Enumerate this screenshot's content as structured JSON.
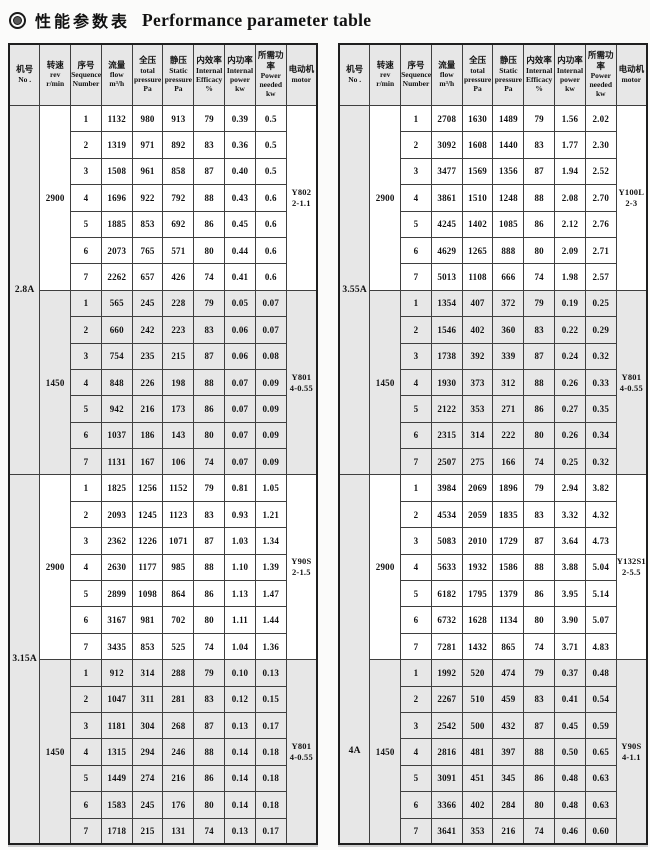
{
  "title": {
    "zh": "性能参数表",
    "en": "Performance parameter table"
  },
  "colors": {
    "cell_shade": "#e7e7e7",
    "cell_white": "#ffffff",
    "border": "#3f3f3f",
    "outer_border": "#1f1f1f",
    "text": "#111111"
  },
  "columns": [
    {
      "zh": "机号",
      "en": "No ."
    },
    {
      "zh": "转速",
      "en": "rev\nr/min"
    },
    {
      "zh": "序号",
      "en": "Sequence\nNumber"
    },
    {
      "zh": "流量",
      "en": "flow\nm³/h"
    },
    {
      "zh": "全压",
      "en": "total\npressure\nPa"
    },
    {
      "zh": "静压",
      "en": "Static\npressure\nPa"
    },
    {
      "zh": "内效率",
      "en": "Internal\nEfficacy\n%"
    },
    {
      "zh": "内功率",
      "en": "Internal\npower\nkw"
    },
    {
      "zh": "所需功率",
      "en": "Power\nneeded\nkw"
    },
    {
      "zh": "电动机",
      "en": "motor"
    }
  ],
  "tables": [
    {
      "name": "performance-table-left",
      "sections": [
        {
          "no": "2.8A",
          "label_pos": "50%",
          "blocks": [
            {
              "rpm": "2900",
              "shade": "white",
              "motor": "Y802\n2-1.1",
              "rows": [
                [
                  "1",
                  "1132",
                  "980",
                  "913",
                  "79",
                  "0.39",
                  "0.5"
                ],
                [
                  "2",
                  "1319",
                  "971",
                  "892",
                  "83",
                  "0.36",
                  "0.5"
                ],
                [
                  "3",
                  "1508",
                  "961",
                  "858",
                  "87",
                  "0.40",
                  "0.5"
                ],
                [
                  "4",
                  "1696",
                  "922",
                  "792",
                  "88",
                  "0.43",
                  "0.6"
                ],
                [
                  "5",
                  "1885",
                  "853",
                  "692",
                  "86",
                  "0.45",
                  "0.6"
                ],
                [
                  "6",
                  "2073",
                  "765",
                  "571",
                  "80",
                  "0.44",
                  "0.6"
                ],
                [
                  "7",
                  "2262",
                  "657",
                  "426",
                  "74",
                  "0.41",
                  "0.6"
                ]
              ]
            },
            {
              "rpm": "1450",
              "shade": "gray",
              "motor": "Y801\n4-0.55",
              "rows": [
                [
                  "1",
                  "565",
                  "245",
                  "228",
                  "79",
                  "0.05",
                  "0.07"
                ],
                [
                  "2",
                  "660",
                  "242",
                  "223",
                  "83",
                  "0.06",
                  "0.07"
                ],
                [
                  "3",
                  "754",
                  "235",
                  "215",
                  "87",
                  "0.06",
                  "0.08"
                ],
                [
                  "4",
                  "848",
                  "226",
                  "198",
                  "88",
                  "0.07",
                  "0.09"
                ],
                [
                  "5",
                  "942",
                  "216",
                  "173",
                  "86",
                  "0.07",
                  "0.09"
                ],
                [
                  "6",
                  "1037",
                  "186",
                  "143",
                  "80",
                  "0.07",
                  "0.09"
                ],
                [
                  "7",
                  "1131",
                  "167",
                  "106",
                  "74",
                  "0.07",
                  "0.09"
                ]
              ]
            }
          ]
        },
        {
          "no": "3.15A",
          "label_pos": "50%",
          "blocks": [
            {
              "rpm": "2900",
              "shade": "white",
              "motor": "Y90S\n2-1.5",
              "rows": [
                [
                  "1",
                  "1825",
                  "1256",
                  "1152",
                  "79",
                  "0.81",
                  "1.05"
                ],
                [
                  "2",
                  "2093",
                  "1245",
                  "1123",
                  "83",
                  "0.93",
                  "1.21"
                ],
                [
                  "3",
                  "2362",
                  "1226",
                  "1071",
                  "87",
                  "1.03",
                  "1.34"
                ],
                [
                  "4",
                  "2630",
                  "1177",
                  "985",
                  "88",
                  "1.10",
                  "1.39"
                ],
                [
                  "5",
                  "2899",
                  "1098",
                  "864",
                  "86",
                  "1.13",
                  "1.47"
                ],
                [
                  "6",
                  "3167",
                  "981",
                  "702",
                  "80",
                  "1.11",
                  "1.44"
                ],
                [
                  "7",
                  "3435",
                  "853",
                  "525",
                  "74",
                  "1.04",
                  "1.36"
                ]
              ]
            },
            {
              "rpm": "1450",
              "shade": "gray",
              "motor": "Y801\n4-0.55",
              "rows": [
                [
                  "1",
                  "912",
                  "314",
                  "288",
                  "79",
                  "0.10",
                  "0.13"
                ],
                [
                  "2",
                  "1047",
                  "311",
                  "281",
                  "83",
                  "0.12",
                  "0.15"
                ],
                [
                  "3",
                  "1181",
                  "304",
                  "268",
                  "87",
                  "0.13",
                  "0.17"
                ],
                [
                  "4",
                  "1315",
                  "294",
                  "246",
                  "88",
                  "0.14",
                  "0.18"
                ],
                [
                  "5",
                  "1449",
                  "274",
                  "216",
                  "86",
                  "0.14",
                  "0.18"
                ],
                [
                  "6",
                  "1583",
                  "245",
                  "176",
                  "80",
                  "0.14",
                  "0.18"
                ],
                [
                  "7",
                  "1718",
                  "215",
                  "131",
                  "74",
                  "0.13",
                  "0.17"
                ]
              ]
            }
          ]
        }
      ]
    },
    {
      "name": "performance-table-right",
      "sections": [
        {
          "no": "3.55A",
          "label_pos": "50%",
          "blocks": [
            {
              "rpm": "2900",
              "shade": "white",
              "motor": "Y100L\n2-3",
              "rows": [
                [
                  "1",
                  "2708",
                  "1630",
                  "1489",
                  "79",
                  "1.56",
                  "2.02"
                ],
                [
                  "2",
                  "3092",
                  "1608",
                  "1440",
                  "83",
                  "1.77",
                  "2.30"
                ],
                [
                  "3",
                  "3477",
                  "1569",
                  "1356",
                  "87",
                  "1.94",
                  "2.52"
                ],
                [
                  "4",
                  "3861",
                  "1510",
                  "1248",
                  "88",
                  "2.08",
                  "2.70"
                ],
                [
                  "5",
                  "4245",
                  "1402",
                  "1085",
                  "86",
                  "2.12",
                  "2.76"
                ],
                [
                  "6",
                  "4629",
                  "1265",
                  "888",
                  "80",
                  "2.09",
                  "2.71"
                ],
                [
                  "7",
                  "5013",
                  "1108",
                  "666",
                  "74",
                  "1.98",
                  "2.57"
                ]
              ]
            },
            {
              "rpm": "1450",
              "shade": "gray",
              "motor": "Y801\n4-0.55",
              "rows": [
                [
                  "1",
                  "1354",
                  "407",
                  "372",
                  "79",
                  "0.19",
                  "0.25"
                ],
                [
                  "2",
                  "1546",
                  "402",
                  "360",
                  "83",
                  "0.22",
                  "0.29"
                ],
                [
                  "3",
                  "1738",
                  "392",
                  "339",
                  "87",
                  "0.24",
                  "0.32"
                ],
                [
                  "4",
                  "1930",
                  "373",
                  "312",
                  "88",
                  "0.26",
                  "0.33"
                ],
                [
                  "5",
                  "2122",
                  "353",
                  "271",
                  "86",
                  "0.27",
                  "0.35"
                ],
                [
                  "6",
                  "2315",
                  "314",
                  "222",
                  "80",
                  "0.26",
                  "0.34"
                ],
                [
                  "7",
                  "2507",
                  "275",
                  "166",
                  "74",
                  "0.25",
                  "0.32"
                ]
              ]
            }
          ]
        },
        {
          "no": "4A",
          "label_pos": "75%",
          "blocks": [
            {
              "rpm": "2900",
              "shade": "white",
              "motor": "Y132S1\n2-5.5",
              "rows": [
                [
                  "1",
                  "3984",
                  "2069",
                  "1896",
                  "79",
                  "2.94",
                  "3.82"
                ],
                [
                  "2",
                  "4534",
                  "2059",
                  "1835",
                  "83",
                  "3.32",
                  "4.32"
                ],
                [
                  "3",
                  "5083",
                  "2010",
                  "1729",
                  "87",
                  "3.64",
                  "4.73"
                ],
                [
                  "4",
                  "5633",
                  "1932",
                  "1586",
                  "88",
                  "3.88",
                  "5.04"
                ],
                [
                  "5",
                  "6182",
                  "1795",
                  "1379",
                  "86",
                  "3.95",
                  "5.14"
                ],
                [
                  "6",
                  "6732",
                  "1628",
                  "1134",
                  "80",
                  "3.90",
                  "5.07"
                ],
                [
                  "7",
                  "7281",
                  "1432",
                  "865",
                  "74",
                  "3.71",
                  "4.83"
                ]
              ]
            },
            {
              "rpm": "1450",
              "shade": "gray",
              "motor": "Y90S\n4-1.1",
              "rows": [
                [
                  "1",
                  "1992",
                  "520",
                  "474",
                  "79",
                  "0.37",
                  "0.48"
                ],
                [
                  "2",
                  "2267",
                  "510",
                  "459",
                  "83",
                  "0.41",
                  "0.54"
                ],
                [
                  "3",
                  "2542",
                  "500",
                  "432",
                  "87",
                  "0.45",
                  "0.59"
                ],
                [
                  "4",
                  "2816",
                  "481",
                  "397",
                  "88",
                  "0.50",
                  "0.65"
                ],
                [
                  "5",
                  "3091",
                  "451",
                  "345",
                  "86",
                  "0.48",
                  "0.63"
                ],
                [
                  "6",
                  "3366",
                  "402",
                  "284",
                  "80",
                  "0.48",
                  "0.63"
                ],
                [
                  "7",
                  "3641",
                  "353",
                  "216",
                  "74",
                  "0.46",
                  "0.60"
                ]
              ]
            }
          ]
        }
      ]
    }
  ]
}
